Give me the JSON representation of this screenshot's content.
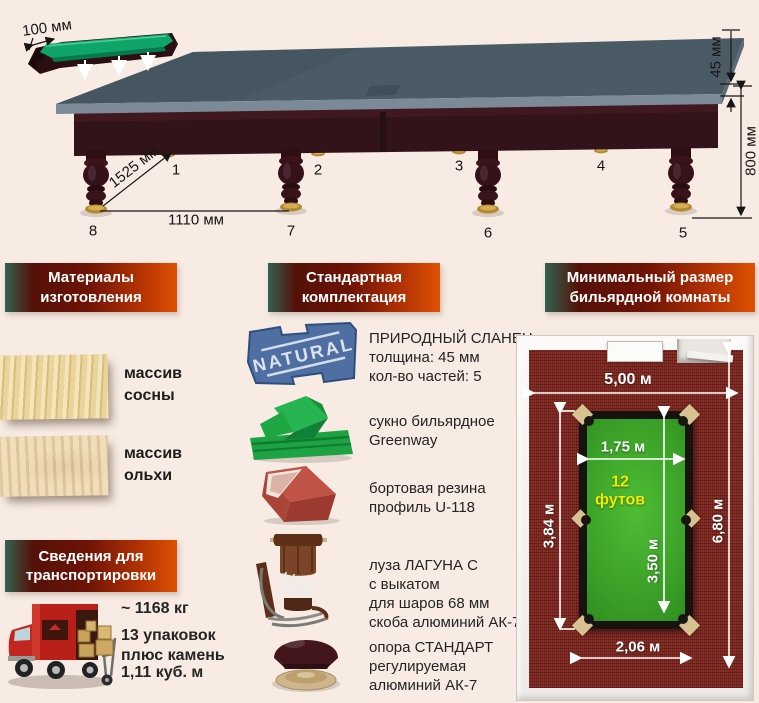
{
  "colors": {
    "background": "#f7ebe3",
    "banner_green": "#33614f",
    "banner_red": "#6e1306",
    "banner_orange": "#de5103",
    "slate_top": "#4a5b66",
    "wood_dark": "#2f1115",
    "cushion_green": "#0fa468",
    "carpet_red": "#7c241d",
    "cloth_green": "#3ba128",
    "slate_icon_blue": "#4f6fa2",
    "size_yellow": "#f2ea00"
  },
  "table_diagram": {
    "rail_width_label": "100 мм",
    "diagonal_label": "1525 мм",
    "leg_span_label": "1110 мм",
    "slate_thickness_label": "45 мм",
    "height_label": "800 мм",
    "legs": [
      "1",
      "2",
      "3",
      "4",
      "5",
      "6",
      "7",
      "8"
    ]
  },
  "materials": {
    "title": "Материалы\nизготовления",
    "items": [
      {
        "name": "pine",
        "label": "массив\nсосны"
      },
      {
        "name": "alder",
        "label": "массив\nольхи"
      }
    ]
  },
  "kit": {
    "title": "Стандартная\nкомплектация",
    "items": [
      {
        "icon": "slate-icon",
        "stamp": "NATURAL",
        "text": "ПРИРОДНЫЙ СЛАНЕЦ\nтолщина: 45 мм\nкол-во частей: 5"
      },
      {
        "icon": "cloth-icon",
        "text": "сукно бильярдное\nGreenway"
      },
      {
        "icon": "cushion-rubber-icon",
        "text": "бортовая резина\nпрофиль U-118"
      },
      {
        "icon": "pocket-icon",
        "text": "луза ЛАГУНА С\nс выкатом\nдля шаров 68 мм\nскоба алюминий АК-7"
      },
      {
        "icon": "leg-support-icon",
        "text": "опора СТАНДАРТ\nрегулируемая\nалюминий АК-7"
      }
    ]
  },
  "transport": {
    "title": "Сведения для\nтранспортировки",
    "weight": "~ 1168 кг",
    "packages": "13 упаковок\nплюс камень",
    "volume": "1,11 куб. м"
  },
  "room": {
    "title": "Минимальный размер\nбильярдной комнаты",
    "room_width": "5,00 м",
    "room_length": "6,80 м",
    "play_width": "1,75 м",
    "table_length": "3,84 м",
    "play_length": "3,50 м",
    "table_width": "2,06 м",
    "table_size": "12\nфутов"
  }
}
